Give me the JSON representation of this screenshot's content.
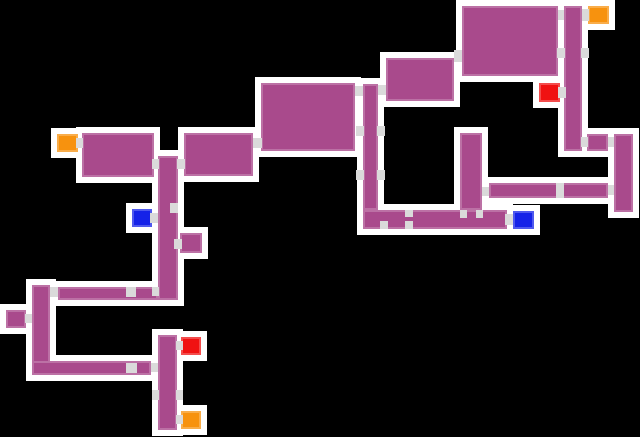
{
  "canvas": {
    "width": 640,
    "height": 437,
    "background": "#000000",
    "outline_thickness": 6
  },
  "palette": {
    "room_fill": "#A94A8C",
    "outline": "#FFFFFF",
    "door": "#DADADA",
    "orange": "#F7920E",
    "red": "#F01212",
    "blue": "#1522E8"
  },
  "map": {
    "rooms": [
      {
        "id": "room-a1",
        "x": 82,
        "y": 133,
        "w": 72,
        "h": 44
      },
      {
        "id": "corridor-a-vertical",
        "x": 158,
        "y": 156,
        "w": 20,
        "h": 144
      },
      {
        "id": "room-a3",
        "x": 184,
        "y": 133,
        "w": 69,
        "h": 43
      },
      {
        "id": "room-side-m",
        "x": 180,
        "y": 233,
        "w": 22,
        "h": 20
      },
      {
        "id": "corridor-n",
        "x": 58,
        "y": 287,
        "w": 100,
        "h": 13
      },
      {
        "id": "corridor-o",
        "x": 32,
        "y": 285,
        "w": 18,
        "h": 90
      },
      {
        "id": "room-p",
        "x": 6,
        "y": 310,
        "w": 20,
        "h": 18
      },
      {
        "id": "corridor-q",
        "x": 32,
        "y": 361,
        "w": 119,
        "h": 14
      },
      {
        "id": "corridor-r",
        "x": 158,
        "y": 335,
        "w": 19,
        "h": 95
      },
      {
        "id": "room-b",
        "x": 261,
        "y": 83,
        "w": 94,
        "h": 68
      },
      {
        "id": "corridor-e",
        "x": 363,
        "y": 84,
        "w": 15,
        "h": 126
      },
      {
        "id": "room-c",
        "x": 386,
        "y": 58,
        "w": 68,
        "h": 43
      },
      {
        "id": "room-d",
        "x": 462,
        "y": 6,
        "w": 96,
        "h": 70
      },
      {
        "id": "corridor-f",
        "x": 564,
        "y": 6,
        "w": 18,
        "h": 145
      },
      {
        "id": "cell-f2",
        "x": 587,
        "y": 134,
        "w": 21,
        "h": 17
      },
      {
        "id": "corridor-j",
        "x": 614,
        "y": 134,
        "w": 19,
        "h": 78
      },
      {
        "id": "corridor-i",
        "x": 489,
        "y": 183,
        "w": 119,
        "h": 15
      },
      {
        "id": "corridor-k",
        "x": 460,
        "y": 133,
        "w": 22,
        "h": 77
      },
      {
        "id": "corridor-h",
        "x": 363,
        "y": 210,
        "w": 144,
        "h": 19
      }
    ],
    "markers": [
      {
        "id": "marker-orange-west",
        "color": "orange",
        "x": 57,
        "y": 134,
        "w": 21,
        "h": 18
      },
      {
        "id": "marker-orange-top-right",
        "color": "orange",
        "x": 588,
        "y": 6,
        "w": 21,
        "h": 18
      },
      {
        "id": "marker-orange-bottom",
        "color": "orange",
        "x": 181,
        "y": 411,
        "w": 20,
        "h": 18
      },
      {
        "id": "marker-red-top-right",
        "color": "red",
        "x": 539,
        "y": 83,
        "w": 21,
        "h": 19
      },
      {
        "id": "marker-red-bottom",
        "color": "red",
        "x": 181,
        "y": 337,
        "w": 20,
        "h": 18
      },
      {
        "id": "marker-blue-left",
        "color": "blue",
        "x": 132,
        "y": 209,
        "w": 20,
        "h": 18
      },
      {
        "id": "marker-blue-right",
        "color": "blue",
        "x": 513,
        "y": 211,
        "w": 21,
        "h": 18
      }
    ],
    "doors": [
      {
        "x": 76,
        "y": 138,
        "w": 7,
        "h": 10
      },
      {
        "x": 152,
        "y": 159,
        "w": 7,
        "h": 10
      },
      {
        "x": 177,
        "y": 159,
        "w": 8,
        "h": 10
      },
      {
        "x": 253,
        "y": 138,
        "w": 9,
        "h": 10
      },
      {
        "x": 170,
        "y": 203,
        "w": 8,
        "h": 10
      },
      {
        "x": 150,
        "y": 213,
        "w": 8,
        "h": 10
      },
      {
        "x": 174,
        "y": 239,
        "w": 8,
        "h": 10
      },
      {
        "x": 126,
        "y": 287,
        "w": 10,
        "h": 10
      },
      {
        "x": 50,
        "y": 287,
        "w": 8,
        "h": 10
      },
      {
        "x": 25,
        "y": 314,
        "w": 7,
        "h": 9
      },
      {
        "x": 152,
        "y": 287,
        "w": 7,
        "h": 9
      },
      {
        "x": 126,
        "y": 363,
        "w": 11,
        "h": 10
      },
      {
        "x": 151,
        "y": 363,
        "w": 7,
        "h": 9
      },
      {
        "x": 152,
        "y": 390,
        "w": 7,
        "h": 10
      },
      {
        "x": 176,
        "y": 390,
        "w": 7,
        "h": 10
      },
      {
        "x": 176,
        "y": 341,
        "w": 7,
        "h": 9
      },
      {
        "x": 176,
        "y": 415,
        "w": 7,
        "h": 9
      },
      {
        "x": 355,
        "y": 86,
        "w": 8,
        "h": 10
      },
      {
        "x": 378,
        "y": 85,
        "w": 8,
        "h": 10
      },
      {
        "x": 356,
        "y": 126,
        "w": 8,
        "h": 10
      },
      {
        "x": 377,
        "y": 126,
        "w": 8,
        "h": 10
      },
      {
        "x": 356,
        "y": 170,
        "w": 8,
        "h": 10
      },
      {
        "x": 377,
        "y": 170,
        "w": 8,
        "h": 10
      },
      {
        "x": 454,
        "y": 50,
        "w": 8,
        "h": 12
      },
      {
        "x": 558,
        "y": 10,
        "w": 6,
        "h": 10
      },
      {
        "x": 557,
        "y": 48,
        "w": 8,
        "h": 10
      },
      {
        "x": 581,
        "y": 48,
        "w": 8,
        "h": 10
      },
      {
        "x": 558,
        "y": 87,
        "w": 8,
        "h": 11
      },
      {
        "x": 582,
        "y": 9,
        "w": 7,
        "h": 12
      },
      {
        "x": 581,
        "y": 137,
        "w": 7,
        "h": 10
      },
      {
        "x": 608,
        "y": 137,
        "w": 6,
        "h": 10
      },
      {
        "x": 608,
        "y": 185,
        "w": 6,
        "h": 10
      },
      {
        "x": 556,
        "y": 183,
        "w": 8,
        "h": 8
      },
      {
        "x": 556,
        "y": 191,
        "w": 8,
        "h": 7
      },
      {
        "x": 482,
        "y": 187,
        "w": 7,
        "h": 9
      },
      {
        "x": 460,
        "y": 210,
        "w": 7,
        "h": 8
      },
      {
        "x": 476,
        "y": 210,
        "w": 7,
        "h": 8
      },
      {
        "x": 380,
        "y": 221,
        "w": 8,
        "h": 8
      },
      {
        "x": 405,
        "y": 221,
        "w": 8,
        "h": 8
      },
      {
        "x": 405,
        "y": 210,
        "w": 8,
        "h": 7
      },
      {
        "x": 505,
        "y": 214,
        "w": 8,
        "h": 11
      }
    ]
  }
}
